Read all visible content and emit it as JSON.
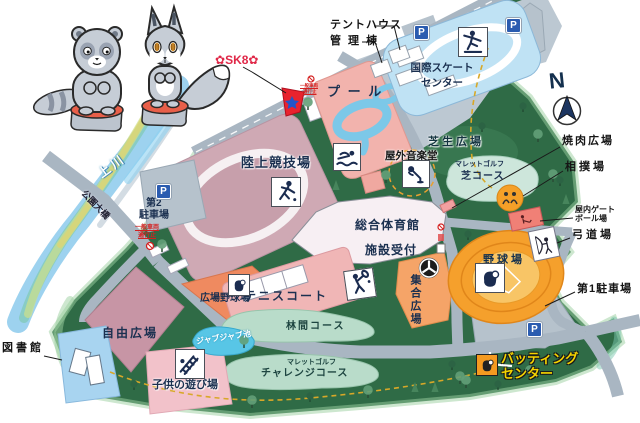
{
  "compass": {
    "north_label": "N"
  },
  "geo": {
    "river_name": "上 川",
    "bridge_name": "公園大橋"
  },
  "parking": {
    "p_label": "P",
    "lot1_label": "第1駐車場",
    "lot2_line1": "第2",
    "lot2_line2": "駐車場"
  },
  "traffic": {
    "no_entry_line1": "一般車両",
    "no_entry_line2": "通行止"
  },
  "facilities": {
    "tent_house": "テントハウス",
    "admin_building": "管 理 棟",
    "sk8": {
      "flower": "✿",
      "label": "SK8"
    },
    "skate_center_line1": "国際スケート",
    "skate_center_line2": "センター",
    "pool": "プ ー ル",
    "athletics_stadium": "陸上競技場",
    "outdoor_music_hall": "屋外音楽堂",
    "lawn_plaza": "芝生広場",
    "mallet_golf_lawn_line1": "マレットゴルフ",
    "mallet_golf_lawn_line2": "芝コース",
    "plaza_baseball_field": "広場野球場",
    "gymnasium": "総合体育館",
    "facility_reception": "施設受付",
    "tennis_court": "テニスコート",
    "assembly_plaza": "集合広場",
    "baseball_stadium": "野球場",
    "bbq_plaza": "焼肉広場",
    "sumo_ring": "相撲場",
    "indoor_gateball_line1": "屋内ゲート",
    "indoor_gateball_line2": "ボール場",
    "kyudo_range": "弓道場",
    "free_plaza": "自由広場",
    "library": "図書館",
    "children_playground": "子供の遊び場",
    "jabujabu_pond": "ジャブジャブ池",
    "forest_course": "林間コース",
    "challenge_line1": "マレットゴルフ",
    "challenge_line2": "チャレンジコース",
    "batting_line1": "バッティング",
    "batting_line2": "センター"
  },
  "colors": {
    "park_green": "#2f6b46",
    "road_gray": "#a9b6c2",
    "stadium_pink": "#cfa9b4",
    "pool_salmon": "#f2b3ad",
    "pool_blue": "#7cc8e8",
    "skate_blue": "#bfe2f4",
    "field_orange": "#f5a02c",
    "diamond_coral": "#ef8a60",
    "accent_red": "#e02848",
    "label_navy": "#1b3050",
    "batting_yellow": "#f5d400"
  }
}
